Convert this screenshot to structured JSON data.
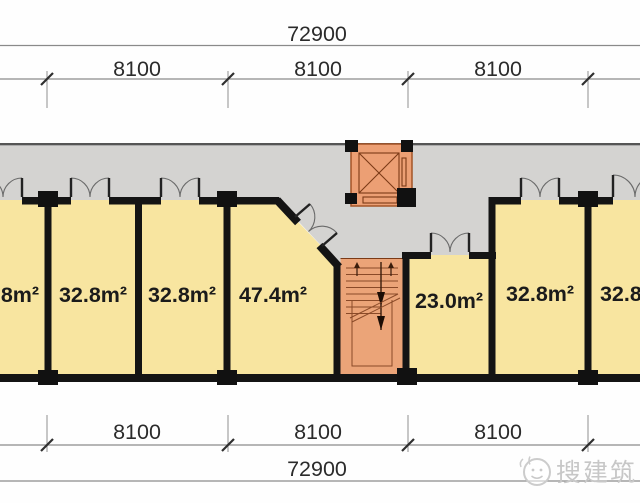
{
  "dimensions": {
    "top": {
      "total": "72900",
      "bays": [
        "8100",
        "8100",
        "8100"
      ]
    },
    "bottom": {
      "total": "72900",
      "bays": [
        "8100",
        "8100",
        "8100"
      ]
    }
  },
  "rooms": [
    {
      "id": "room-1",
      "area": "32.8m²",
      "clipped": "left edge of image"
    },
    {
      "id": "room-2",
      "area": "32.8m²"
    },
    {
      "id": "room-3",
      "area": "32.8m²"
    },
    {
      "id": "room-4",
      "area": "47.4m²"
    },
    {
      "id": "room-5",
      "area": "23.0m²"
    },
    {
      "id": "room-6",
      "area": "32.8m²"
    },
    {
      "id": "room-7",
      "area": "32.8m²",
      "clipped": "right edge of image"
    }
  ],
  "core_features": [
    "elevator-shaft",
    "staircase",
    "double-door-symbols"
  ],
  "watermark": {
    "text": "搜建筑"
  },
  "colors": {
    "room_fill": "#f8e5a0",
    "corridor_fill": "#d4d3d1",
    "core_fill": "#eba478",
    "wall": "#141414",
    "dimension_text": "#2b2b2b",
    "watermark": "#c8c8c8"
  }
}
